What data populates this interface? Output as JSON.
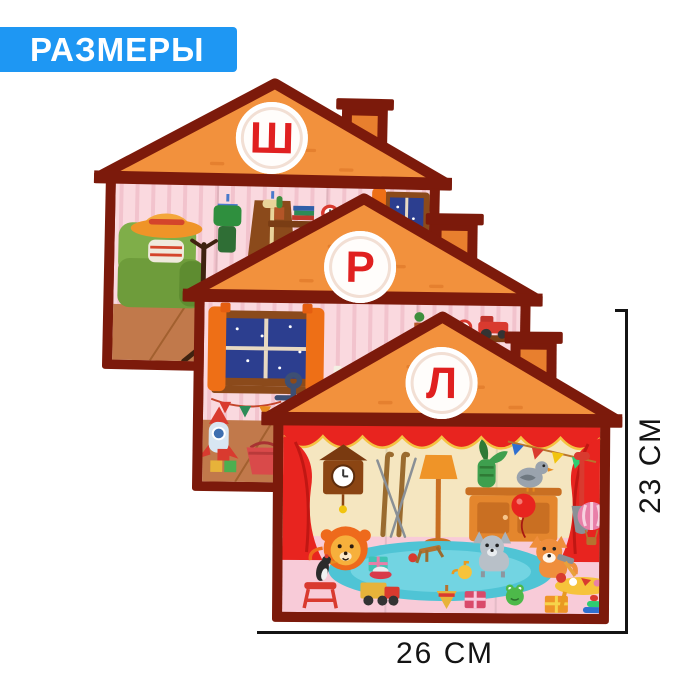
{
  "header": {
    "label": "РАЗМЕРЫ"
  },
  "houses": [
    {
      "letter": "Ш",
      "items": [
        "armchair",
        "granny-hat",
        "scarf",
        "teddy-bear",
        "coat-rack",
        "hanging-outfit",
        "hanging-coat",
        "wall-shelves",
        "books",
        "cactus",
        "alarm-clock",
        "frog-toy",
        "gift-box",
        "dresser",
        "night-window",
        "orange-curtains",
        "toy-block"
      ]
    },
    {
      "letter": "Р",
      "items": [
        "night-window",
        "orange-curtains",
        "bunting-flags",
        "anchor-toy",
        "rocket-toy",
        "wall-shelves",
        "books",
        "alarm-clock",
        "toy-tractor",
        "rainbow-toy",
        "nightstand",
        "table-lamp",
        "candle",
        "apple",
        "bucket",
        "toy-blocks",
        "pumpkin",
        "slipper"
      ]
    },
    {
      "letter": "Л",
      "items": [
        "stage-curtains",
        "cuckoo-clock",
        "skis",
        "floor-lamp",
        "plant-vase",
        "pigeon",
        "cabinet",
        "bunting-flags",
        "balloon",
        "shovel",
        "hot-air-balloon",
        "lion",
        "wolf",
        "fox",
        "frog-toy",
        "woodpecker",
        "stool",
        "play-rug",
        "toy-truck",
        "gift-boxes",
        "kids-table",
        "pyramid-toy",
        "spinning-top",
        "hammer-toy",
        "saucer-plate",
        "teapot",
        "ball"
      ]
    }
  ],
  "dimensions": {
    "height_label": "23 СМ",
    "width_label": "26 СМ"
  },
  "colors": {
    "banner_blue": "#1E97F3",
    "roof_orange": "#F2913D",
    "frame_maroon": "#7C1A0B",
    "letter_red": "#E02020",
    "wall_pink": "#FAD9DF",
    "floor_wood": "#C1794B",
    "stage_floor_pink": "#F8CBD8",
    "dimension_text": "#141414"
  }
}
